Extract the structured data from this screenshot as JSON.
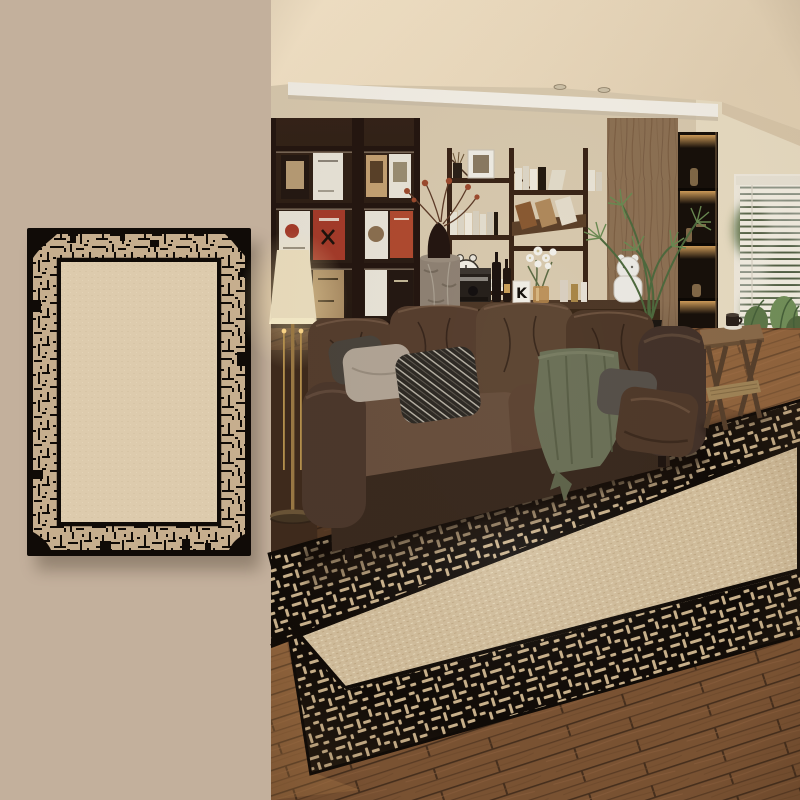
{
  "meta": {
    "kind": "rug-product-lifestyle-composite",
    "left_panel_content": "rug swatch on plain beige background",
    "right_panel_content": "living room photo with same rug under leather sofa"
  },
  "palette": {
    "panel_bg": "#c3b09c",
    "ink_black": "#100b07",
    "rug_border_beige": "#c6ae8e",
    "rug_field": "#ddcbad",
    "scene_rug_field": "#d5c19f",
    "rug_mark_beige": "#cdb58f",
    "ceiling_light": "#f3e3c8",
    "ceiling_dark": "#e3d1b5",
    "vent_white": "#f3efe6",
    "wall": "#d8c9ae",
    "wall_right": "#e8dcc2",
    "bookshelf_wood": "#342318",
    "frame_dark": "#241610",
    "shelf_wood": "#3a2517",
    "column_wood": "#8d7154",
    "niche_dark": "#17100a",
    "glow_amber": "#cf9a58",
    "blind_white": "#f3eee2",
    "foliage": "#5d7847",
    "foliage_dark": "#46603a",
    "sofa_dark": "#3a291e",
    "sofa_mid": "#553e2e",
    "sofa_light": "#69503e",
    "sofa_front": "#3a2a1f",
    "blanket_green": "#6c7158",
    "pillow_beige": "#b2a596",
    "pillow_pattern": "#2e2a25",
    "pillow_gray": "#57514a",
    "pillow_brown": "#503a2b",
    "floor_dark": "#3f2b1d",
    "floor_mid": "#7c5434",
    "floor_light": "#9a6a44",
    "bench_wood": "#a57c4e",
    "table_wood": "#8a6a4a",
    "lamp_shade": "#ecdfbf",
    "brass": "#9c7a45",
    "stone": "#8f8274",
    "magazine_white": "#e9e4d8",
    "magazine_red": "#a53b2a",
    "magazine_tan": "#c4a173",
    "magazine_dark": "#241812",
    "magazine_orange": "#b04a30",
    "white_decor": "#eceae4"
  },
  "scene": {
    "console": {
      "letter_card": "K"
    }
  }
}
